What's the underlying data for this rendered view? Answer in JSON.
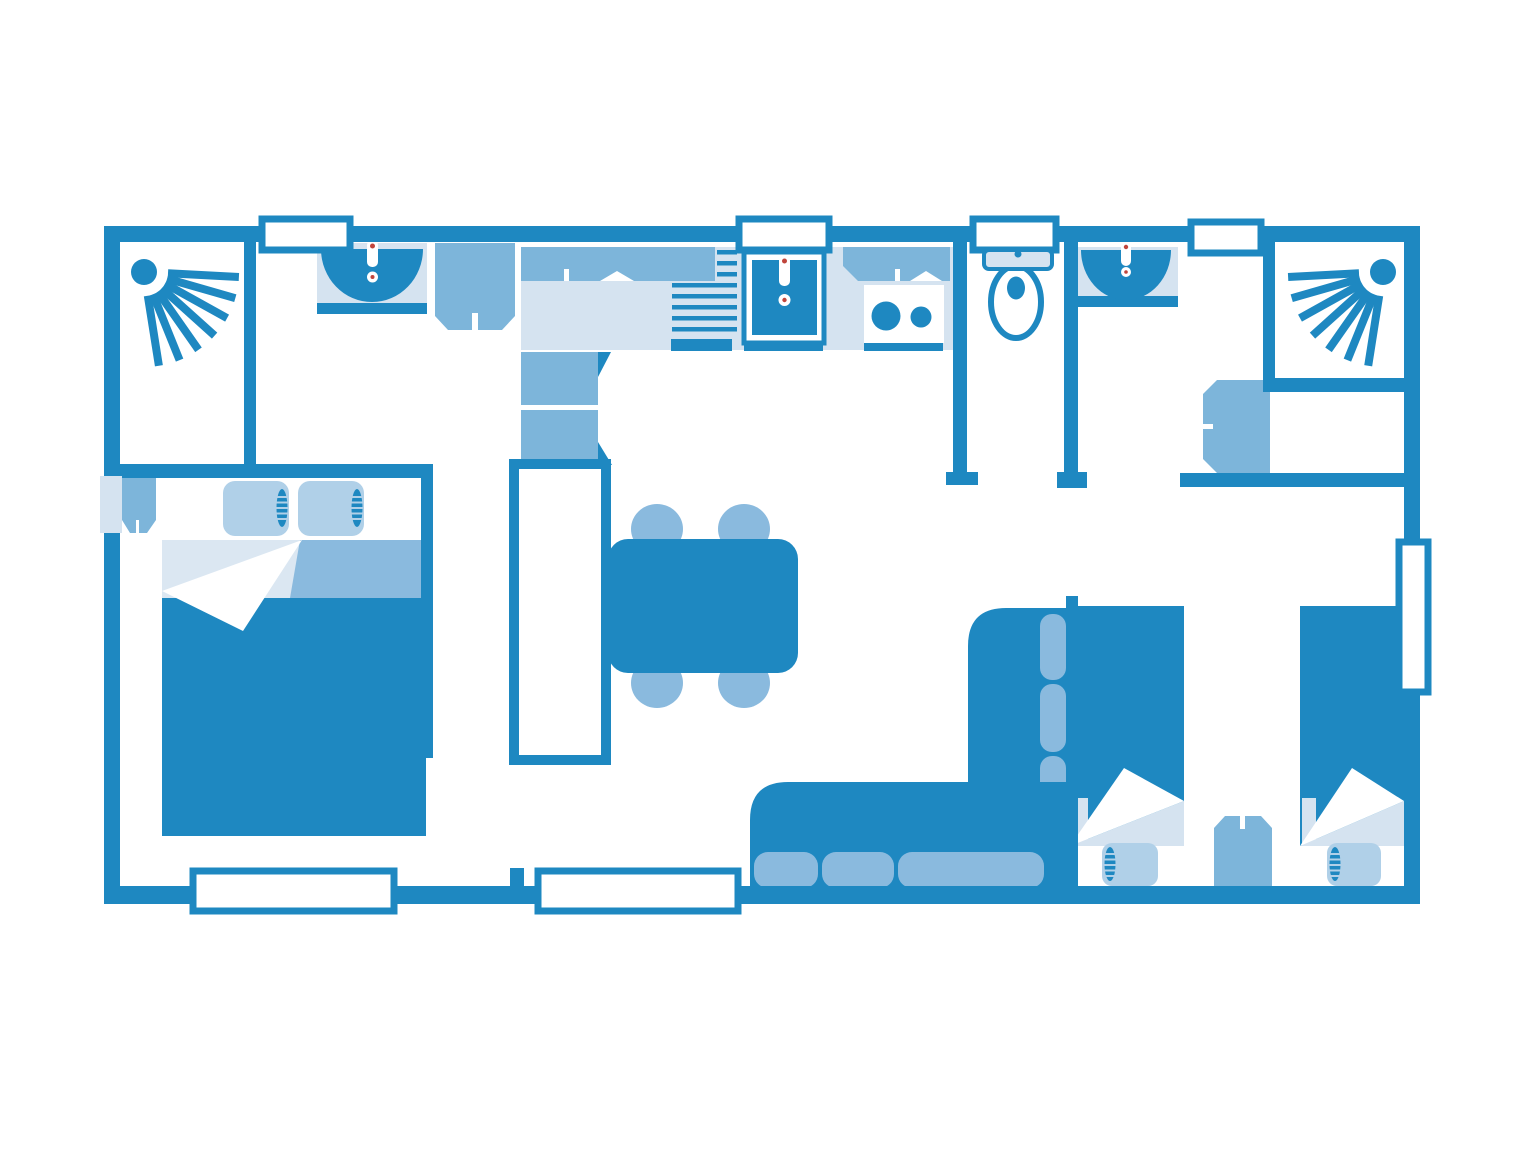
{
  "canvas": {
    "width": 1536,
    "height": 1152,
    "background": "#ffffff"
  },
  "colors": {
    "bg": "#ffffff",
    "wall": "#1e88c1",
    "medium": "#7db5da",
    "light": "#d5e3f0",
    "lighter": "#dbe7f2",
    "cushion": "#8abade",
    "pillow": "#b0d0e8",
    "white": "#ffffff",
    "accent_red": "#c0453c"
  },
  "plan": {
    "type": "floor-plan",
    "style": "flat two-tone blue mobile-home plan, top-down view, no text labels",
    "rooms": [
      {
        "name": "bathroom-left",
        "fixtures": [
          "corner-shower-with-spray-icon",
          "washbasin-with-faucet",
          "wardrobe"
        ]
      },
      {
        "name": "master-bedroom",
        "fixtures": [
          "double-bed-with-two-pillows",
          "folded-blanket",
          "bedside-shelf",
          "wall-niche"
        ]
      },
      {
        "name": "kitchen",
        "fixtures": [
          "upper-cabinet-band-left",
          "upper-cabinet-band-right",
          "counter",
          "dish-drainer-grill",
          "kitchen-sink-with-faucet",
          "stove-two-burners",
          "tall-cabinet-fridge",
          "hall-wardrobe"
        ]
      },
      {
        "name": "living-dining",
        "fixtures": [
          "dining-table",
          "chair",
          "chair",
          "chair",
          "chair",
          "corner-sofa-with-cushions"
        ]
      },
      {
        "name": "wc",
        "fixtures": [
          "toilet-with-cistern"
        ]
      },
      {
        "name": "bathroom-right",
        "fixtures": [
          "washbasin-with-faucet",
          "corner-shower-with-spray-icon",
          "wardrobe",
          "storage-niche"
        ]
      },
      {
        "name": "twin-bedroom",
        "fixtures": [
          "single-bed",
          "single-bed",
          "nightstand"
        ]
      }
    ],
    "openings": {
      "top_windows": 4,
      "bottom_windows": 2,
      "right_wall_windows": 1,
      "door_gaps": [
        "master-bedroom",
        "kitchen-passage",
        "wc",
        "bathroom-right",
        "twin-bedroom"
      ]
    }
  }
}
